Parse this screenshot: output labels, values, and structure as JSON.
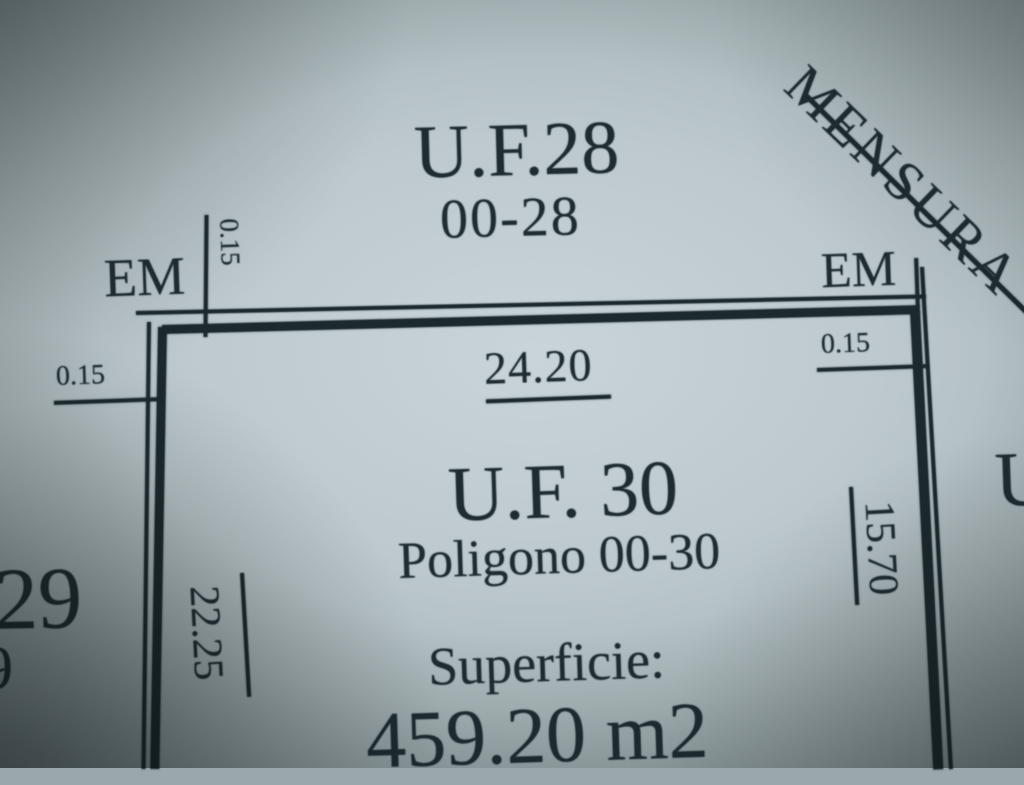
{
  "plan": {
    "upper_parcel": {
      "title": "U.F.28",
      "code": "00-28"
    },
    "main_parcel": {
      "title": "U.F. 30",
      "polygon": "Poligono 00-30",
      "area_label": "Superficie:",
      "area_value": "459.20 m2"
    },
    "left_parcel": {
      "number_partial": "29",
      "code_digit_partial": "9"
    },
    "right_parcel": {
      "title_partial": "U"
    },
    "stamp_diagonal": "MENSURA",
    "wall_labels": {
      "left": "EM",
      "right": "EM"
    },
    "dimensions": {
      "top_width": "24.20",
      "left_depth": "22.25",
      "right_depth": "15.70",
      "offset_top_left": "0.15",
      "offset_left": "0.15",
      "offset_right": "0.15"
    }
  },
  "colors": {
    "paper": "#bdc9cd",
    "ink": "#1c292d"
  }
}
